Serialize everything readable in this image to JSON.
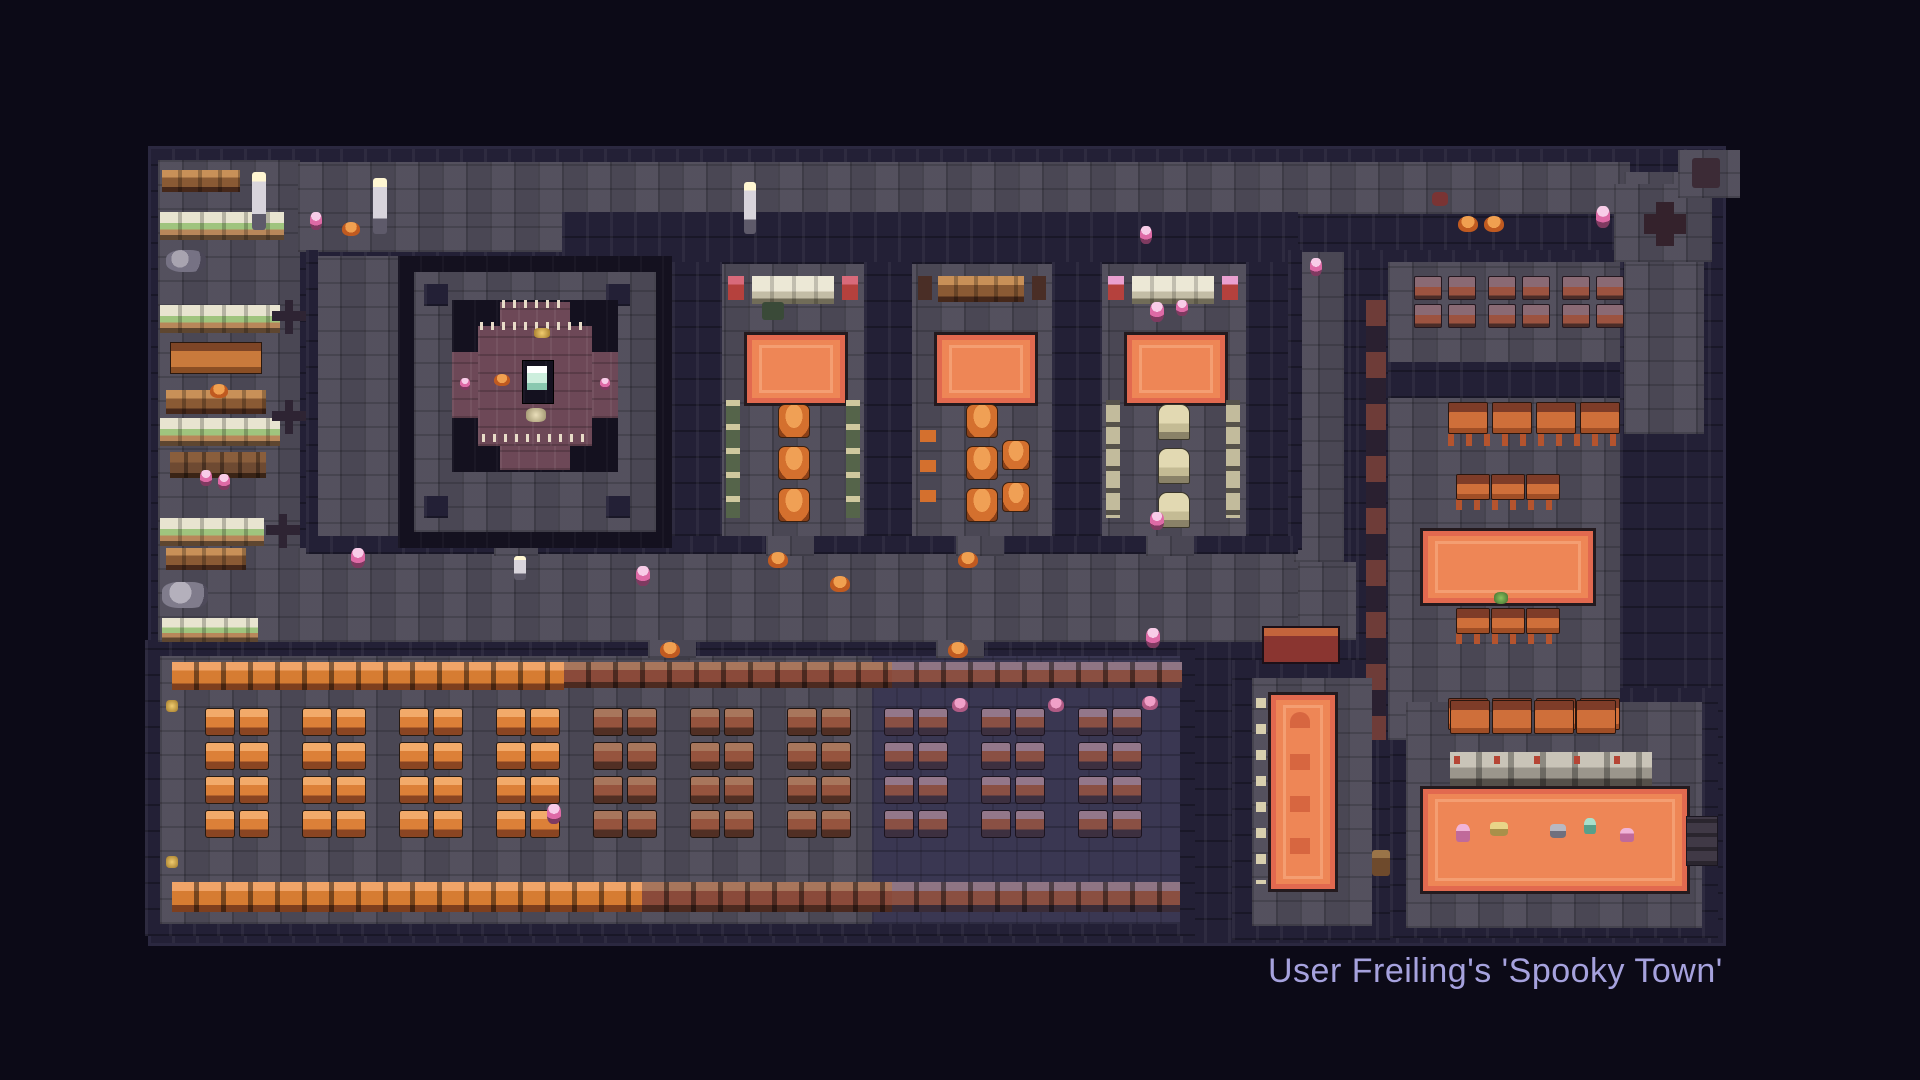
{
  "caption": {
    "text": "User Freiling's 'Spooky Town'"
  },
  "palette": {
    "background": "#0c0a17",
    "path_stone": "#4e4b59",
    "floor_navy": "#3a3752",
    "wall": "#232036",
    "wall_dark": "#14111f",
    "rug_orange": "#ee8656",
    "rug_border": "#f5a277",
    "chest_bright": "#dc8038",
    "chest_muted": "#8a5044",
    "altar_platform_purple": "#6d4857",
    "altar_glow": "#cdeedd",
    "caption_text": "#a6a2de"
  },
  "map": {
    "furniture": {
      "clusters": [
        {
          "name": "chest-cluster",
          "variant": "bright",
          "x": 205,
          "y": 708,
          "cols": 2,
          "rows": 4,
          "cw": 28,
          "ch": 26,
          "gx": 6,
          "gy": 8
        },
        {
          "name": "chest-cluster",
          "variant": "bright",
          "x": 302,
          "y": 708,
          "cols": 2,
          "rows": 4,
          "cw": 28,
          "ch": 26,
          "gx": 6,
          "gy": 8
        },
        {
          "name": "chest-cluster",
          "variant": "bright",
          "x": 399,
          "y": 708,
          "cols": 2,
          "rows": 4,
          "cw": 28,
          "ch": 26,
          "gx": 6,
          "gy": 8
        },
        {
          "name": "chest-cluster",
          "variant": "bright",
          "x": 496,
          "y": 708,
          "cols": 2,
          "rows": 4,
          "cw": 28,
          "ch": 26,
          "gx": 6,
          "gy": 8
        },
        {
          "name": "chest-cluster",
          "variant": "mid",
          "x": 593,
          "y": 708,
          "cols": 2,
          "rows": 4,
          "cw": 28,
          "ch": 26,
          "gx": 6,
          "gy": 8
        },
        {
          "name": "chest-cluster",
          "variant": "mid",
          "x": 690,
          "y": 708,
          "cols": 2,
          "rows": 4,
          "cw": 28,
          "ch": 26,
          "gx": 6,
          "gy": 8
        },
        {
          "name": "chest-cluster",
          "variant": "mid",
          "x": 787,
          "y": 708,
          "cols": 2,
          "rows": 4,
          "cw": 28,
          "ch": 26,
          "gx": 6,
          "gy": 8
        },
        {
          "name": "chest-cluster",
          "variant": "muted",
          "x": 884,
          "y": 708,
          "cols": 2,
          "rows": 4,
          "cw": 28,
          "ch": 26,
          "gx": 6,
          "gy": 8
        },
        {
          "name": "chest-cluster",
          "variant": "muted",
          "x": 981,
          "y": 708,
          "cols": 2,
          "rows": 4,
          "cw": 28,
          "ch": 26,
          "gx": 6,
          "gy": 8
        },
        {
          "name": "chest-cluster",
          "variant": "muted",
          "x": 1078,
          "y": 708,
          "cols": 2,
          "rows": 4,
          "cw": 28,
          "ch": 26,
          "gx": 6,
          "gy": 8
        },
        {
          "name": "bed-pair-group",
          "variant": "bed",
          "x": 1414,
          "y": 276,
          "cols": 2,
          "rows": 2,
          "cw": 26,
          "ch": 22,
          "gx": 8,
          "gy": 6
        },
        {
          "name": "bed-pair-group",
          "variant": "bed",
          "x": 1488,
          "y": 276,
          "cols": 2,
          "rows": 2,
          "cw": 26,
          "ch": 22,
          "gx": 8,
          "gy": 6
        },
        {
          "name": "bed-pair-group",
          "variant": "bed",
          "x": 1562,
          "y": 276,
          "cols": 2,
          "rows": 2,
          "cw": 26,
          "ch": 22,
          "gx": 8,
          "gy": 6
        },
        {
          "name": "pumpkin-chair-column",
          "variant": "pumpkin-chair",
          "x": 778,
          "y": 404,
          "cols": 1,
          "rows": 3,
          "cw": 30,
          "ch": 32,
          "gx": 0,
          "gy": 10
        },
        {
          "name": "pumpkin-chair-column",
          "variant": "pumpkin-chair",
          "x": 966,
          "y": 404,
          "cols": 1,
          "rows": 3,
          "cw": 30,
          "ch": 32,
          "gx": 0,
          "gy": 10
        },
        {
          "name": "pumpkin-chair-column",
          "variant": "pumpkin-chair",
          "x": 1002,
          "y": 440,
          "cols": 1,
          "rows": 2,
          "cw": 26,
          "ch": 28,
          "gx": 0,
          "gy": 14
        },
        {
          "name": "tombstone-column",
          "variant": "tomb",
          "x": 1158,
          "y": 404,
          "cols": 1,
          "rows": 3,
          "cw": 30,
          "ch": 34,
          "gx": 0,
          "gy": 10
        },
        {
          "name": "table-row",
          "variant": "table",
          "x": 1448,
          "y": 402,
          "cols": 4,
          "rows": 1,
          "cw": 38,
          "ch": 30,
          "gx": 6,
          "gy": 0
        },
        {
          "name": "table-row",
          "variant": "table",
          "x": 1456,
          "y": 474,
          "cols": 3,
          "rows": 1,
          "cw": 32,
          "ch": 24,
          "gx": 3,
          "gy": 0
        },
        {
          "name": "table-row",
          "variant": "table",
          "x": 1456,
          "y": 608,
          "cols": 3,
          "rows": 1,
          "cw": 32,
          "ch": 24,
          "gx": 3,
          "gy": 0
        },
        {
          "name": "table-row",
          "variant": "table",
          "x": 1448,
          "y": 698,
          "cols": 4,
          "rows": 1,
          "cw": 38,
          "ch": 30,
          "gx": 6,
          "gy": 0
        },
        {
          "name": "table-row",
          "variant": "table",
          "x": 1450,
          "y": 700,
          "cols": 4,
          "rows": 1,
          "cw": 38,
          "ch": 32,
          "gx": 4,
          "gy": 0
        }
      ],
      "dots": [
        {
          "name": "torch",
          "variant": "torch",
          "x": 252,
          "y": 172,
          "w": 14,
          "h": 58
        },
        {
          "name": "torch",
          "variant": "torch",
          "x": 373,
          "y": 178,
          "w": 14,
          "h": 56
        },
        {
          "name": "torch",
          "variant": "torch",
          "x": 744,
          "y": 182,
          "w": 12,
          "h": 52
        },
        {
          "name": "torch",
          "variant": "torch",
          "x": 514,
          "y": 556,
          "w": 12,
          "h": 24
        },
        {
          "name": "pink-candle",
          "variant": "candle-pink",
          "x": 310,
          "y": 212,
          "w": 12,
          "h": 18
        },
        {
          "name": "pink-candle",
          "variant": "candle-pink",
          "x": 1140,
          "y": 226,
          "w": 12,
          "h": 18
        },
        {
          "name": "pink-candle",
          "variant": "candle-pink",
          "x": 1310,
          "y": 258,
          "w": 12,
          "h": 18
        },
        {
          "name": "pink-candle",
          "variant": "candle-pink",
          "x": 636,
          "y": 566,
          "w": 14,
          "h": 20
        },
        {
          "name": "pink-candle",
          "variant": "candle-pink",
          "x": 351,
          "y": 548,
          "w": 14,
          "h": 20
        },
        {
          "name": "pink-candle",
          "variant": "candle-pink",
          "x": 1150,
          "y": 302,
          "w": 14,
          "h": 20
        },
        {
          "name": "pink-candle",
          "variant": "candle-pink",
          "x": 1176,
          "y": 300,
          "w": 12,
          "h": 16
        },
        {
          "name": "pink-candle",
          "variant": "candle-pink",
          "x": 1150,
          "y": 512,
          "w": 14,
          "h": 18
        },
        {
          "name": "pink-candle",
          "variant": "candle-pink",
          "x": 547,
          "y": 804,
          "w": 14,
          "h": 20
        },
        {
          "name": "pink-candle",
          "variant": "candle-pink",
          "x": 1146,
          "y": 628,
          "w": 14,
          "h": 20
        },
        {
          "name": "pink-candle",
          "variant": "candle-pink",
          "x": 1596,
          "y": 206,
          "w": 14,
          "h": 22
        },
        {
          "name": "pumpkin",
          "variant": "pumpkin",
          "x": 342,
          "y": 222,
          "w": 18,
          "h": 14
        },
        {
          "name": "pumpkin",
          "variant": "pumpkin",
          "x": 830,
          "y": 576,
          "w": 20,
          "h": 16
        },
        {
          "name": "pumpkin",
          "variant": "pumpkin",
          "x": 768,
          "y": 552,
          "w": 20,
          "h": 16
        },
        {
          "name": "pumpkin",
          "variant": "pumpkin",
          "x": 958,
          "y": 552,
          "w": 20,
          "h": 16
        },
        {
          "name": "pumpkin",
          "variant": "pumpkin",
          "x": 660,
          "y": 642,
          "w": 20,
          "h": 16
        },
        {
          "name": "pumpkin",
          "variant": "pumpkin",
          "x": 948,
          "y": 642,
          "w": 20,
          "h": 16
        },
        {
          "name": "pumpkin",
          "variant": "pumpkin",
          "x": 1458,
          "y": 216,
          "w": 20,
          "h": 16
        },
        {
          "name": "pumpkin",
          "variant": "pumpkin",
          "x": 1484,
          "y": 216,
          "w": 20,
          "h": 16
        },
        {
          "name": "pumpkin",
          "variant": "pumpkin",
          "x": 210,
          "y": 384,
          "w": 18,
          "h": 14
        },
        {
          "name": "pink-pumpkin",
          "variant": "pumpkin-pink",
          "x": 952,
          "y": 698,
          "w": 16,
          "h": 14
        },
        {
          "name": "pink-pumpkin",
          "variant": "pumpkin-pink",
          "x": 1048,
          "y": 698,
          "w": 16,
          "h": 14
        },
        {
          "name": "pink-pumpkin",
          "variant": "pumpkin-pink",
          "x": 1142,
          "y": 696,
          "w": 16,
          "h": 14
        },
        {
          "name": "gold-item",
          "variant": "golddot",
          "x": 534,
          "y": 328,
          "w": 16,
          "h": 10
        },
        {
          "name": "gold-item",
          "variant": "golddot",
          "x": 166,
          "y": 700,
          "w": 12,
          "h": 12
        },
        {
          "name": "gold-item",
          "variant": "golddot",
          "x": 166,
          "y": 856,
          "w": 12,
          "h": 12
        },
        {
          "name": "cream-item",
          "variant": "creamdot",
          "x": 526,
          "y": 408,
          "w": 20,
          "h": 14
        },
        {
          "name": "altar-side-candle",
          "variant": "candle-pink",
          "x": 460,
          "y": 378,
          "w": 10,
          "h": 12
        },
        {
          "name": "altar-side-candle",
          "variant": "candle-pink",
          "x": 600,
          "y": 378,
          "w": 10,
          "h": 12
        },
        {
          "name": "altar-offering",
          "variant": "pumpkin",
          "x": 494,
          "y": 374,
          "w": 16,
          "h": 12
        },
        {
          "name": "maroon-item",
          "variant": "maroondot",
          "x": 1432,
          "y": 192,
          "w": 16,
          "h": 14
        },
        {
          "name": "green-plant",
          "variant": "greenplant",
          "x": 1494,
          "y": 592,
          "w": 14,
          "h": 12
        },
        {
          "name": "rug-figure",
          "variant": "fig-pink",
          "x": 1456,
          "y": 824,
          "w": 14,
          "h": 18
        },
        {
          "name": "rug-figure",
          "variant": "fig-gold",
          "x": 1490,
          "y": 822,
          "w": 18,
          "h": 14
        },
        {
          "name": "rug-figure",
          "variant": "fig-gray",
          "x": 1550,
          "y": 824,
          "w": 16,
          "h": 14
        },
        {
          "name": "rug-figure",
          "variant": "fig-teal",
          "x": 1584,
          "y": 818,
          "w": 12,
          "h": 16
        },
        {
          "name": "rug-figure",
          "variant": "fig-pink",
          "x": 1620,
          "y": 828,
          "w": 14,
          "h": 14
        },
        {
          "name": "door-post",
          "variant": "postbrown",
          "x": 1372,
          "y": 850,
          "w": 18,
          "h": 26
        }
      ]
    }
  }
}
